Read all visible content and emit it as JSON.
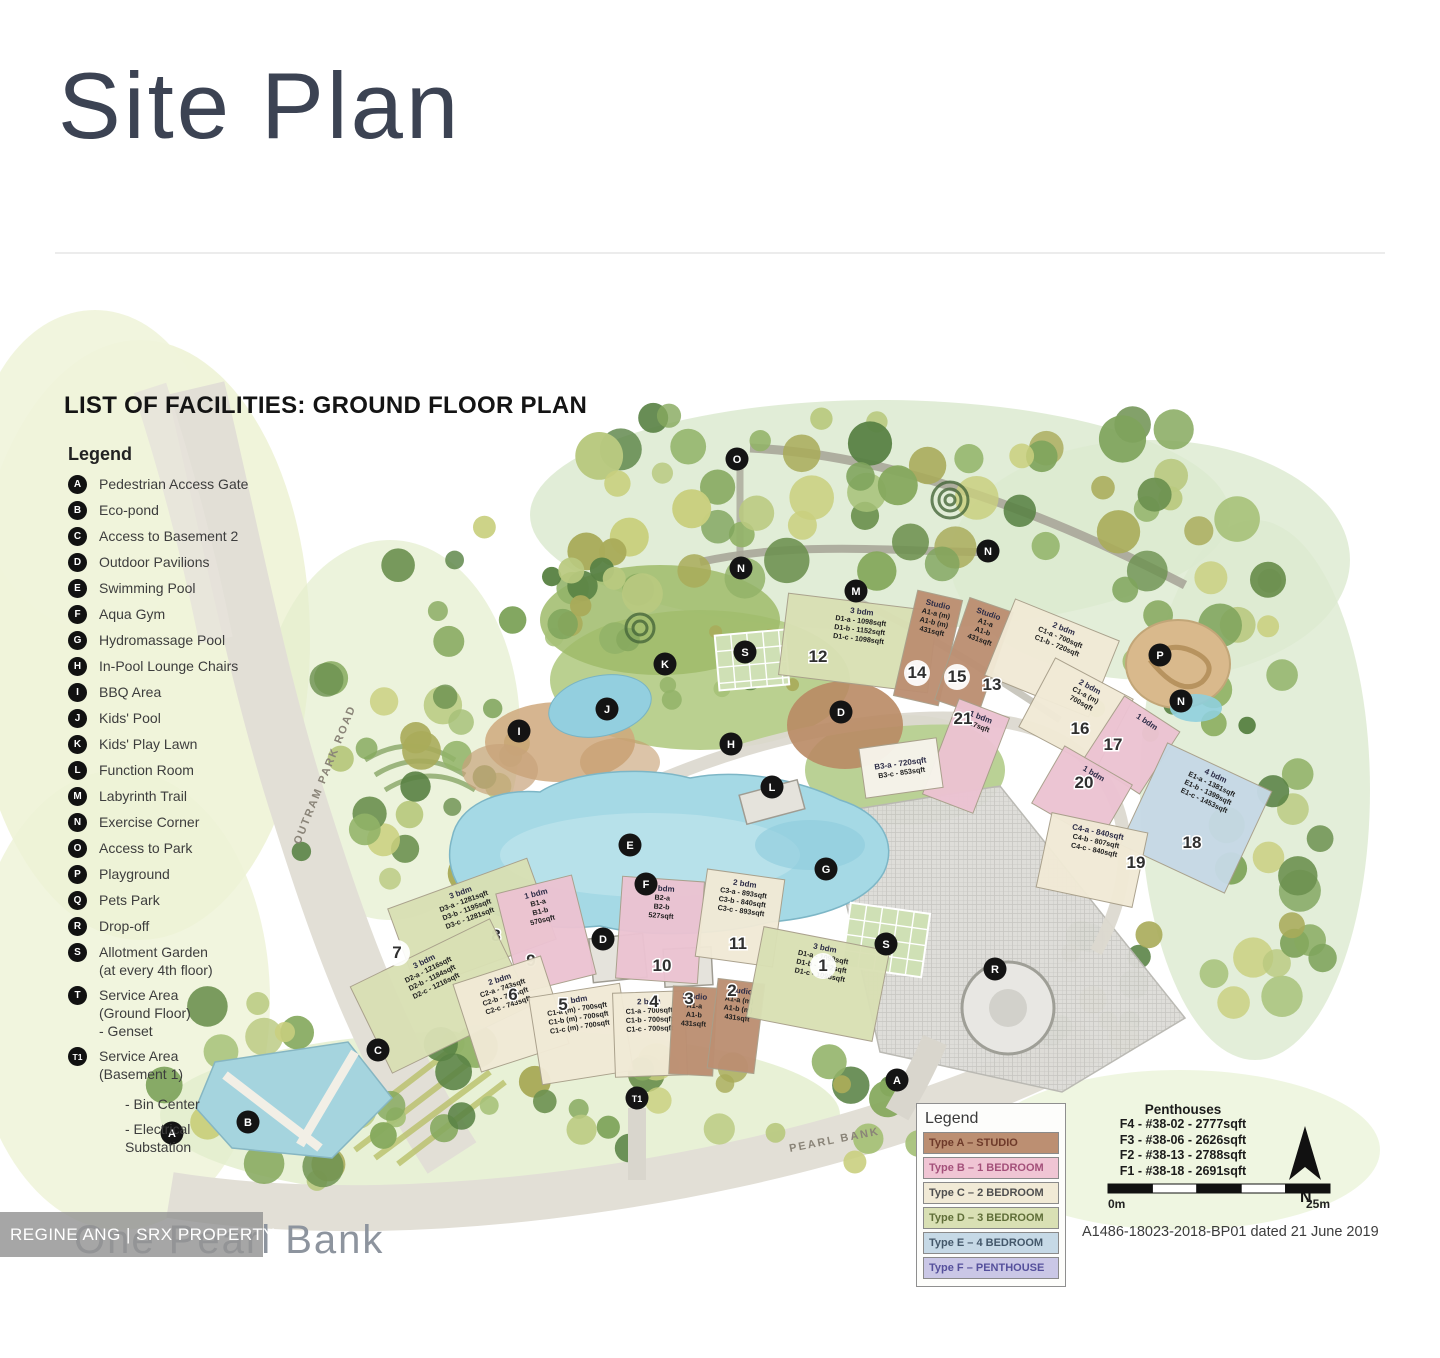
{
  "page": {
    "title": "Site Plan"
  },
  "map": {
    "heading": "LIST OF FACILITIES: GROUND FLOOR PLAN",
    "legend_title": "Legend",
    "legend_items": [
      {
        "key": "A",
        "lines": [
          "Pedestrian Access Gate"
        ]
      },
      {
        "key": "B",
        "lines": [
          "Eco-pond"
        ]
      },
      {
        "key": "C",
        "lines": [
          "Access to Basement 2"
        ]
      },
      {
        "key": "D",
        "lines": [
          "Outdoor Pavilions"
        ]
      },
      {
        "key": "E",
        "lines": [
          "Swimming Pool"
        ]
      },
      {
        "key": "F",
        "lines": [
          "Aqua Gym"
        ]
      },
      {
        "key": "G",
        "lines": [
          "Hydromassage Pool"
        ]
      },
      {
        "key": "H",
        "lines": [
          "In-Pool Lounge Chairs"
        ]
      },
      {
        "key": "I",
        "lines": [
          "BBQ Area"
        ]
      },
      {
        "key": "J",
        "lines": [
          "Kids' Pool"
        ]
      },
      {
        "key": "K",
        "lines": [
          "Kids' Play Lawn"
        ]
      },
      {
        "key": "L",
        "lines": [
          "Function Room"
        ]
      },
      {
        "key": "M",
        "lines": [
          "Labyrinth Trail"
        ]
      },
      {
        "key": "N",
        "lines": [
          "Exercise Corner"
        ]
      },
      {
        "key": "O",
        "lines": [
          "Access to Park"
        ]
      },
      {
        "key": "P",
        "lines": [
          "Playground"
        ]
      },
      {
        "key": "Q",
        "lines": [
          "Pets Park"
        ]
      },
      {
        "key": "R",
        "lines": [
          "Drop-off"
        ]
      },
      {
        "key": "S",
        "lines": [
          "Allotment Garden",
          "(at every 4th floor)"
        ]
      },
      {
        "key": "T",
        "lines": [
          "Service Area",
          "(Ground Floor)",
          "- Genset"
        ]
      },
      {
        "key": "T1",
        "lines": [
          "Service Area",
          "(Basement 1)"
        ]
      }
    ],
    "legend_notes": [
      "- Bin Center",
      "- Electrical\nSubstation"
    ],
    "road_labels": [
      "OUTRAM PARK ROAD",
      "PEARL BANK"
    ],
    "type_colors": {
      "A": "#bc8f72",
      "B": "#ecc3d2",
      "C": "#f1ead6",
      "D": "#d9e0b4",
      "E": "#c6d9e6",
      "F": "#cac7e6",
      "tag": "#f7f4ec"
    },
    "buildings": [
      {
        "num": "12",
        "type": "D",
        "cx": 858,
        "cy": 643,
        "w": 150,
        "h": 82,
        "rot": 7,
        "lines": [
          "3 bdm",
          "D1-a - 1098sqft",
          "D1-b - 1152sqft",
          "D1-c - 1098sqft"
        ],
        "nx": 818,
        "ny": 662
      },
      {
        "num": "14",
        "type": "A",
        "cx": 928,
        "cy": 648,
        "w": 46,
        "h": 108,
        "rot": 13,
        "lines": [
          "Studio",
          "A1-a (m)",
          "A1-b (m)",
          "431sqft"
        ],
        "nx": 917,
        "ny": 678,
        "circled": true
      },
      {
        "num": "15",
        "type": "A",
        "cx": 974,
        "cy": 656,
        "w": 46,
        "h": 108,
        "rot": 19,
        "lines": [
          "Studio",
          "A1-a",
          "A1-b",
          "431sqft"
        ],
        "nx": 957,
        "ny": 682,
        "circled": true
      },
      {
        "num": "13",
        "type": "C",
        "cx": 1052,
        "cy": 658,
        "w": 112,
        "h": 82,
        "rot": 22,
        "lines": [
          "2 bdm",
          "C1-a - 700sqft",
          "C1-b - 720sqft"
        ],
        "nx": 992,
        "ny": 690
      },
      {
        "num": "21",
        "type": "B",
        "cx": 966,
        "cy": 756,
        "w": 54,
        "h": 102,
        "rot": 21,
        "lines": [
          "1 bdm",
          "527sqft"
        ],
        "nx": 963,
        "ny": 724
      },
      {
        "num": "16",
        "type": "C",
        "cx": 1076,
        "cy": 713,
        "w": 88,
        "h": 78,
        "rot": 28,
        "lines": [
          "2 bdm",
          "C1-a (m)",
          "700sqft"
        ],
        "nx": 1080,
        "ny": 734
      },
      {
        "num": "17",
        "type": "B",
        "cx": 1132,
        "cy": 745,
        "w": 66,
        "h": 74,
        "rot": 33,
        "lines": [
          "1 bdm"
        ],
        "nx": 1113,
        "ny": 750
      },
      {
        "num": "20",
        "type": "B",
        "cx": 1082,
        "cy": 794,
        "w": 78,
        "h": 66,
        "rot": 30,
        "lines": [
          "1 bdm"
        ],
        "nx": 1084,
        "ny": 788
      },
      {
        "num": "18",
        "type": "E",
        "cx": 1196,
        "cy": 818,
        "w": 115,
        "h": 112,
        "rot": 25,
        "lines": [
          "4 bdm",
          "E1-a - 1381sqft",
          "E1-b - 1399sqft",
          "E1-c - 1453sqft"
        ],
        "nx": 1192,
        "ny": 848
      },
      {
        "num": "19",
        "type": "C",
        "cx": 1092,
        "cy": 860,
        "w": 98,
        "h": 76,
        "rot": 12,
        "lines": [
          "C4-a - 840sqft",
          "C4-b - 807sqft",
          "C4-c - 840sqft"
        ],
        "nx": 1136,
        "ny": 868
      },
      {
        "num": "",
        "type": "tag",
        "cx": 901,
        "cy": 768,
        "w": 78,
        "h": 50,
        "rot": -8,
        "lines": [
          "B3-a - 720sqft",
          "B3-c - 853sqft"
        ],
        "nx": 0,
        "ny": 0
      },
      {
        "num": "8",
        "type": "D",
        "cx": 472,
        "cy": 924,
        "w": 148,
        "h": 86,
        "rot": -20,
        "lines": [
          "3 bdm",
          "D3-a - 1281sqft",
          "D3-b - 1195sqft",
          "D3-c - 1281sqft"
        ],
        "nx": 496,
        "ny": 941
      },
      {
        "num": "9",
        "type": "B",
        "cx": 546,
        "cy": 934,
        "w": 78,
        "h": 102,
        "rot": -14,
        "lines": [
          "1 bdm",
          "B1-a",
          "B1-b",
          "570sqft"
        ],
        "nx": 531,
        "ny": 966
      },
      {
        "num": "10",
        "type": "B",
        "cx": 660,
        "cy": 930,
        "w": 82,
        "h": 102,
        "rot": 4,
        "lines": [
          "1 bdm",
          "B2-a",
          "B2-b",
          "527sqft"
        ],
        "nx": 662,
        "ny": 971
      },
      {
        "num": "11",
        "type": "C",
        "cx": 740,
        "cy": 918,
        "w": 78,
        "h": 88,
        "rot": 8,
        "lines": [
          "2 bdm",
          "C3-a - 893sqft",
          "C3-b - 840sqft",
          "C3-c - 893sqft"
        ],
        "nx": 738,
        "ny": 949
      },
      {
        "num": "7",
        "type": "D",
        "cx": 441,
        "cy": 996,
        "w": 155,
        "h": 96,
        "rot": -26,
        "lines": [
          "3 bdm",
          "D2-a - 1216sqft",
          "D2-b - 1184sqft",
          "D2-c - 1216sqft"
        ],
        "nx": 397,
        "ny": 958,
        "circled": true
      },
      {
        "num": "6",
        "type": "C",
        "cx": 511,
        "cy": 1014,
        "w": 92,
        "h": 92,
        "rot": -18,
        "lines": [
          "2 bdm",
          "C2-a - 743sqft",
          "C2-b - 743sqft",
          "C2-c - 743sqft"
        ],
        "nx": 513,
        "ny": 1000
      },
      {
        "num": "5",
        "type": "C",
        "cx": 581,
        "cy": 1034,
        "w": 92,
        "h": 88,
        "rot": -9,
        "lines": [
          "2 bdm",
          "C1-a (m) - 700sqft",
          "C1-b (m) - 700sqft",
          "C1-c (m) - 700sqft"
        ],
        "nx": 563,
        "ny": 1010
      },
      {
        "num": "4",
        "type": "C",
        "cx": 650,
        "cy": 1034,
        "w": 72,
        "h": 84,
        "rot": -2,
        "lines": [
          "2 bdm",
          "C1-a - 700sqft",
          "C1-b - 700sqft",
          "C1-c - 700sqft"
        ],
        "nx": 654,
        "ny": 1007
      },
      {
        "num": "3",
        "type": "A",
        "cx": 693,
        "cy": 1031,
        "w": 44,
        "h": 88,
        "rot": 3,
        "lines": [
          "Studio",
          "A1-a",
          "A1-b",
          "431sqft"
        ],
        "nx": 689,
        "ny": 1004
      },
      {
        "num": "2",
        "type": "A",
        "cx": 736,
        "cy": 1026,
        "w": 47,
        "h": 90,
        "rot": 7,
        "lines": [
          "Studio",
          "A1-a (m)",
          "A1-b (m)",
          "431sqft"
        ],
        "nx": 732,
        "ny": 996
      },
      {
        "num": "1",
        "type": "D",
        "cx": 818,
        "cy": 984,
        "w": 128,
        "h": 92,
        "rot": 11,
        "lines": [
          "3 bdm",
          "D1-a - 1098sqft",
          "D1-b - 1152sqft",
          "D1-c - 1098sqft"
        ],
        "nx": 823,
        "ny": 971,
        "circled": true
      }
    ],
    "markers": [
      {
        "label": "O",
        "x": 737,
        "y": 459
      },
      {
        "label": "N",
        "x": 741,
        "y": 568
      },
      {
        "label": "N",
        "x": 988,
        "y": 551
      },
      {
        "label": "M",
        "x": 856,
        "y": 591
      },
      {
        "label": "K",
        "x": 665,
        "y": 664
      },
      {
        "label": "S",
        "x": 745,
        "y": 652
      },
      {
        "label": "P",
        "x": 1160,
        "y": 655
      },
      {
        "label": "N",
        "x": 1181,
        "y": 701
      },
      {
        "label": "J",
        "x": 607,
        "y": 709
      },
      {
        "label": "I",
        "x": 519,
        "y": 731
      },
      {
        "label": "D",
        "x": 841,
        "y": 712
      },
      {
        "label": "H",
        "x": 731,
        "y": 744
      },
      {
        "label": "L",
        "x": 772,
        "y": 787
      },
      {
        "label": "E",
        "x": 630,
        "y": 845
      },
      {
        "label": "F",
        "x": 646,
        "y": 884
      },
      {
        "label": "G",
        "x": 826,
        "y": 869
      },
      {
        "label": "D",
        "x": 603,
        "y": 939
      },
      {
        "label": "S",
        "x": 886,
        "y": 944
      },
      {
        "label": "R",
        "x": 995,
        "y": 969
      },
      {
        "label": "A",
        "x": 897,
        "y": 1080
      },
      {
        "label": "T1",
        "x": 637,
        "y": 1098
      },
      {
        "label": "C",
        "x": 378,
        "y": 1050
      },
      {
        "label": "B",
        "x": 248,
        "y": 1122
      },
      {
        "label": "A",
        "x": 172,
        "y": 1133
      }
    ],
    "unit_legend": {
      "title": "Legend",
      "rows": [
        {
          "label": "Type A – STUDIO",
          "bg": "#bc8f72",
          "fg": "#6e3a2a"
        },
        {
          "label": "Type B – 1 BEDROOM",
          "bg": "#f0c5d4",
          "fg": "#a4507a"
        },
        {
          "label": "Type C – 2 BEDROOM",
          "bg": "#f1ead6",
          "fg": "#4f4f4f"
        },
        {
          "label": "Type D – 3 BEDROOM",
          "bg": "#d9e0b4",
          "fg": "#5f6e38"
        },
        {
          "label": "Type E – 4 BEDROOM",
          "bg": "#c6d9e6",
          "fg": "#44586a"
        },
        {
          "label": "Type F – PENTHOUSE",
          "bg": "#cac7e6",
          "fg": "#55509c"
        }
      ]
    },
    "penthouses": {
      "title": "Penthouses",
      "rows": [
        "F4 - #38-02 - 2777sqft",
        "F3 - #38-06 - 2626sqft",
        "F2 - #38-13 - 2788sqft",
        "F1 - #38-18 - 2691sqft"
      ]
    },
    "scale": {
      "left": "0m",
      "right": "25m"
    },
    "compass_label": "N",
    "doc_ref": "A1486-18023-2018-BP01 dated 21 June 2019"
  },
  "footer": {
    "watermark": "REGINE ANG | SRX PROPERTY",
    "logo": "One Pearl Bank"
  }
}
